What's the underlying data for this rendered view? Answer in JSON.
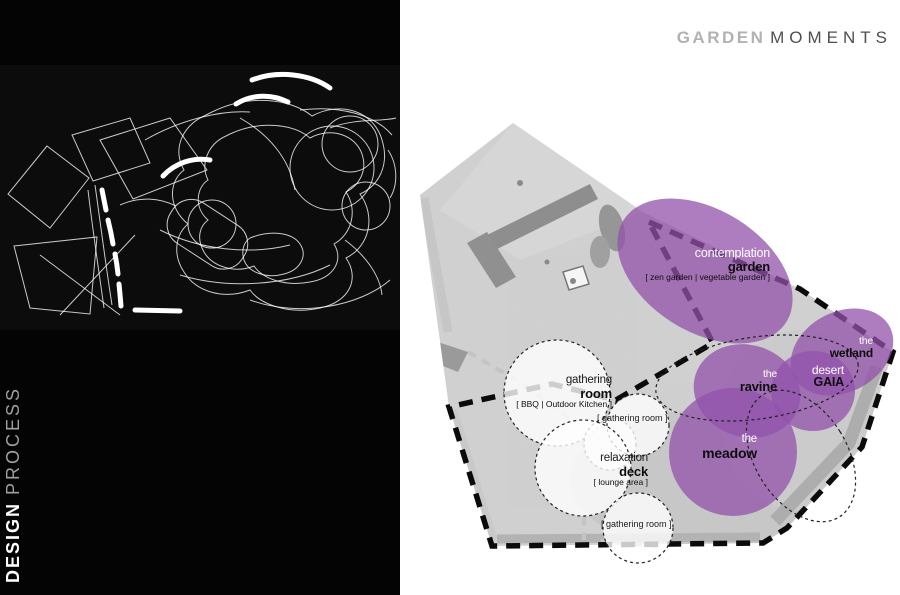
{
  "header": {
    "title_primary": "GARDEN",
    "title_secondary": "MOMENTS"
  },
  "left_panel": {
    "caption_primary": "DESIGN",
    "caption_secondary": "PROCESS"
  },
  "plan": {
    "moments": [
      {
        "name": "contemplation-garden",
        "line1": "contemplation",
        "line2": "garden",
        "line3": "[ zen garden | vegetable garden ]"
      },
      {
        "name": "the-wetland",
        "line1": "the",
        "line2": "wetland"
      },
      {
        "name": "desert-gaia",
        "line1": "desert",
        "line2": "GAIA"
      },
      {
        "name": "the-ravine",
        "line1": "the",
        "line2": "ravine"
      },
      {
        "name": "the-meadow",
        "line1": "the",
        "line2": "meadow"
      }
    ],
    "rooms": [
      {
        "name": "gathering-room",
        "line1": "gathering",
        "line2": "room",
        "line3": "[ BBQ | Outdoor Kitchen ]"
      },
      {
        "name": "gathering-room-upper",
        "label": "[ gathering room ]"
      },
      {
        "name": "relaxation-deck",
        "line1": "relaxation",
        "line2": "deck",
        "line3": "[ lounge area ]"
      },
      {
        "name": "gathering-room-lower",
        "label": "[ gathering room ]"
      }
    ],
    "colors": {
      "moment_purple": "#9152ab",
      "boundary_black": "#0b0b0b",
      "photo_gray": "#d9d9d9",
      "panel_black": "#040404"
    }
  }
}
